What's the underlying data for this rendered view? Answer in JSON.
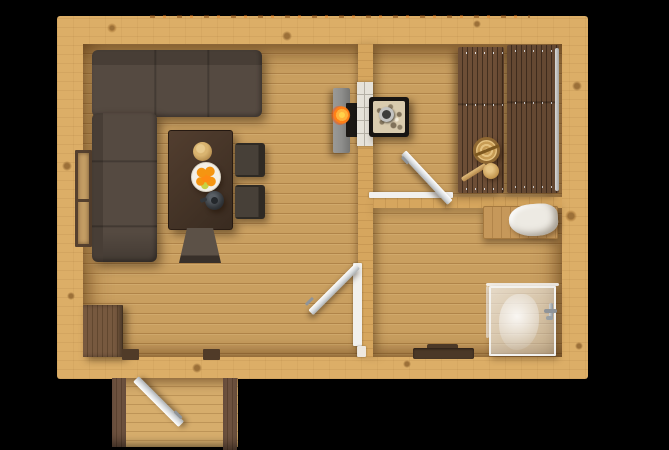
{
  "scene": {
    "type": "floor-plan-3d-render",
    "description": "Top-down 3D render of a one-storey wooden sauna cabin floor plan on a black background",
    "background": "#000000"
  },
  "rooms": [
    {
      "id": "living-room",
      "label": "living room with lounge and dining area"
    },
    {
      "id": "sauna",
      "label": "sauna with tiered benches and stone heater"
    },
    {
      "id": "washroom",
      "label": "washroom with shower cabin"
    },
    {
      "id": "porch",
      "label": "entry porch with open front door"
    }
  ],
  "objects": [
    "corner-sofa",
    "dining-table",
    "wooden-plate",
    "fruit-plate-with-oranges",
    "kettle",
    "dining-chair-top",
    "dining-chair-bottom",
    "low-chair",
    "storage-cabinet",
    "left-wall-window",
    "wood-stove-concrete-surround",
    "stove-firebox-flame",
    "sauna-stone-heater",
    "chimney-pipe",
    "sauna-bench-lower",
    "sauna-bench-upper",
    "sauna-bucket",
    "sauna-ladle",
    "sauna-glass-rail",
    "sauna-door-open",
    "washroom-door-open",
    "towel-crate",
    "folded-towel",
    "shower-glass-cabin",
    "shower-faucet",
    "drain-tray",
    "entry-door-open",
    "porch-posts"
  ],
  "colors": {
    "bgBlack": "#000000",
    "wallPine": "#dcae67",
    "wallInner": "#d6a65e",
    "knot": "#9c7038",
    "floorBase": "#c99f60",
    "floorGap": "#b08449",
    "porchFloor": "#d6ad6c",
    "porchGap": "#bd9457",
    "sofaBase": "#554a41",
    "sofaDark": "#483e36",
    "tableBase": "#523e2f",
    "tableEdge": "#392b20",
    "chairBase": "#474038",
    "chairDark": "#2f2a24",
    "lowChair": "#5c5147",
    "cabinet": "#77593f",
    "cabinetDark": "#61472f",
    "windowFrame": "#55402e",
    "windowPanel": "#c49d64",
    "concrete": "#8e8e8c",
    "firebox": "#1b1815",
    "flameOuter": "#ff7f17",
    "flameCore": "#ffd24a",
    "brick": "#e6e2d9",
    "brickSeam": "#b5b0a6",
    "stoneBox": "#171412",
    "stones": "#d9cbae",
    "chimneyRing": "#c3c3c1",
    "chimneyHole": "#3d3d3b",
    "bench": "#6d4e36",
    "benchGap": "#432f1f",
    "bucket": "#d9b470",
    "bucketEdge": "#8f6832",
    "frameWhite": "#f1f0ed",
    "metal": "#8f9499",
    "crate": "#c6985a",
    "towel": "#edeae3",
    "glassEdge": "rgba(248,250,252,0.85)",
    "tray": "#4b3827",
    "jamb": "#503b28",
    "post": "#6f5340",
    "plate": "#f3efe6",
    "orange": "#f59511",
    "lime": "#c6d245",
    "kettle": "#33373b"
  }
}
